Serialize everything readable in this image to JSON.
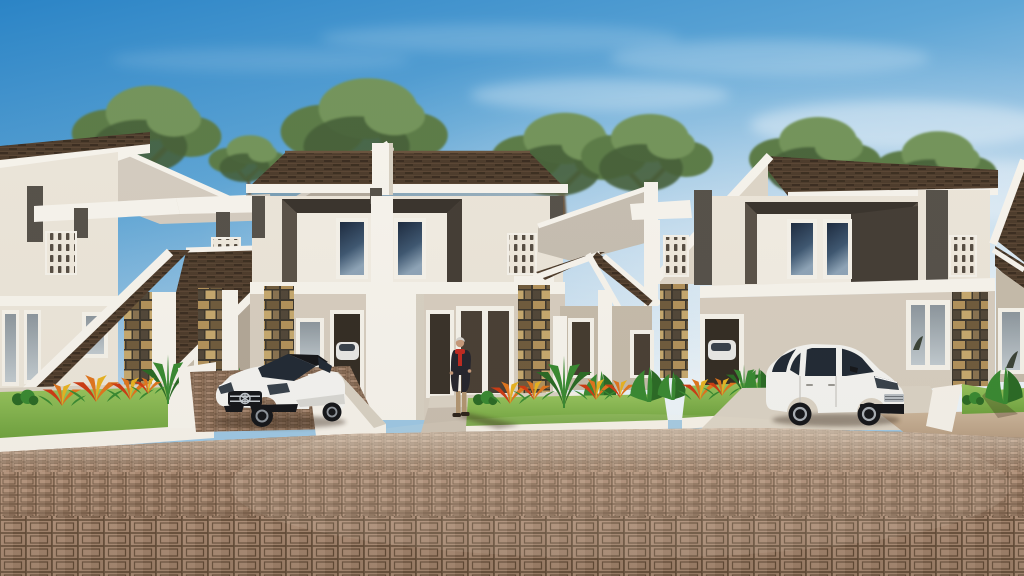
{
  "scene": {
    "title": "Modern two-storey housing estate - 3D exterior architectural visualization",
    "description": "Daytime render of a row of cream two-storey duplex townhouses with dark brown shingle roofs, dark recessed window box frames, stone-veneer porch columns, breeze-block screens, front garden beds with orange bromeliads and agave plants, a white sedan and a white hatchback parked on driveways, an elderly man in a dark coat and red scarf standing on the walkway, trees behind the roofline, and a wide brown interlocking-paver forecourt under a clear blue sky",
    "time_of_day": "day",
    "weather": "clear sky with thin wispy clouds",
    "houses": {
      "count": 4,
      "storeys": 2,
      "features": [
        "dark shingle gable roofs",
        "white fascia boards",
        "dark window box frames",
        "stone veneer columns",
        "breeze-block ventilation screens",
        "white canopy slabs",
        "front garden beds with white curbs"
      ]
    },
    "vehicles": [
      {
        "name": "white-sedan",
        "description": "white luxury sedan with black grille and star emblem",
        "position": "left driveway, facing viewer"
      },
      {
        "name": "white-hatchback",
        "description": "white compact hatchback with silver alloy wheels",
        "position": "right driveway, facing right"
      }
    ],
    "person": {
      "description": "grey-haired man standing, long dark coat, red scarf, tan trousers",
      "position": "centre walkway in front of right duplex unit"
    },
    "landscaping": {
      "trees_behind_roofline": 7,
      "garden_beds": 4,
      "plants": [
        "agave",
        "orange bromeliad",
        "red bromeliad",
        "banana leaf shrub",
        "grasses"
      ]
    },
    "paving": {
      "type": "interlocking concrete pavers",
      "pattern": "concentric rectangle blocks",
      "color": "brown-tan with dark joints"
    }
  },
  "colors": {
    "sky_top": "#2b84c6",
    "sky_mid": "#5fa6d6",
    "sky_low": "#a8cde8",
    "sky_horizon": "#e9f3f9",
    "cloud_white": "#ffffff",
    "foliage_light": "#74955b",
    "foliage_mid": "#5d7d49",
    "foliage_dark": "#47613a",
    "branch_brown": "#6a563f",
    "roof_shingle": "#4e3d2d",
    "roof_shingle_dark": "#30251a",
    "roof_shingle_light": "#6b543f",
    "roof_pale": "#d5cdc1",
    "roof_pale_shade": "#c7bfb2",
    "fascia_white": "#f7f4ed",
    "wall_cream": "#ece6da",
    "wall_cream_shade": "#ded6c8",
    "wall_beige": "#d7cec0",
    "wall_beige_shade": "#c6bcab",
    "underporch": "#b3a898",
    "accent_dark_gray": "#57524b",
    "box_frame": "#5b5349",
    "box_frame_side": "#453e37",
    "box_frame_top": "#3b352e",
    "box_inner": "#f2ede3",
    "window_frame": "#f5f2ea",
    "glass_dark": "#1e2c40",
    "glass_mid": "#3f5872",
    "glass_light": "#8fa5b8",
    "glass_gray": "#a9b3ba",
    "stone_grout": "#3e382e",
    "stone_tan": "#b2925c",
    "stone_brown": "#705c3e",
    "stone_dark": "#52483a",
    "stone_light": "#c6a96f",
    "stone_gray": "#8a7452",
    "breeze_white": "#efe9dd",
    "breeze_slot": "#574e44",
    "lawn": "#7fb04a",
    "lawn_light": "#98c55f",
    "lawn_dark": "#639139",
    "plant_green": "#3a8a33",
    "plant_green_dark": "#2c6b26",
    "flower_orange": "#e0761f",
    "flower_red": "#cd3c15",
    "flower_yellow": "#e8b322",
    "paver": "#b29179",
    "paver_joint": "#6a523d",
    "paver_light": "#cdb49a",
    "paver_shade": "#8d7158",
    "concrete": "#dbd3c5",
    "concrete_shade": "#c9bfb0",
    "curb_white": "#f6f2ea",
    "curb_shade": "#d8d1c3",
    "road_tan": "#c3ab90",
    "car_white": "#f4f4f1",
    "car_white_shade": "#d9d8d4",
    "car_glass": "#222b36",
    "car_dark": "#16171b",
    "car_chrome": "#c4cacf",
    "rim_gray": "#8f959c",
    "skin": "#c79a7b",
    "hair_gray": "#d6d3ce",
    "coat_dark": "#26262e",
    "scarf_red": "#bf2b22",
    "pants_tan": "#b29672",
    "shoe_dark": "#2e241c",
    "shadow": "#3a2a1c"
  }
}
